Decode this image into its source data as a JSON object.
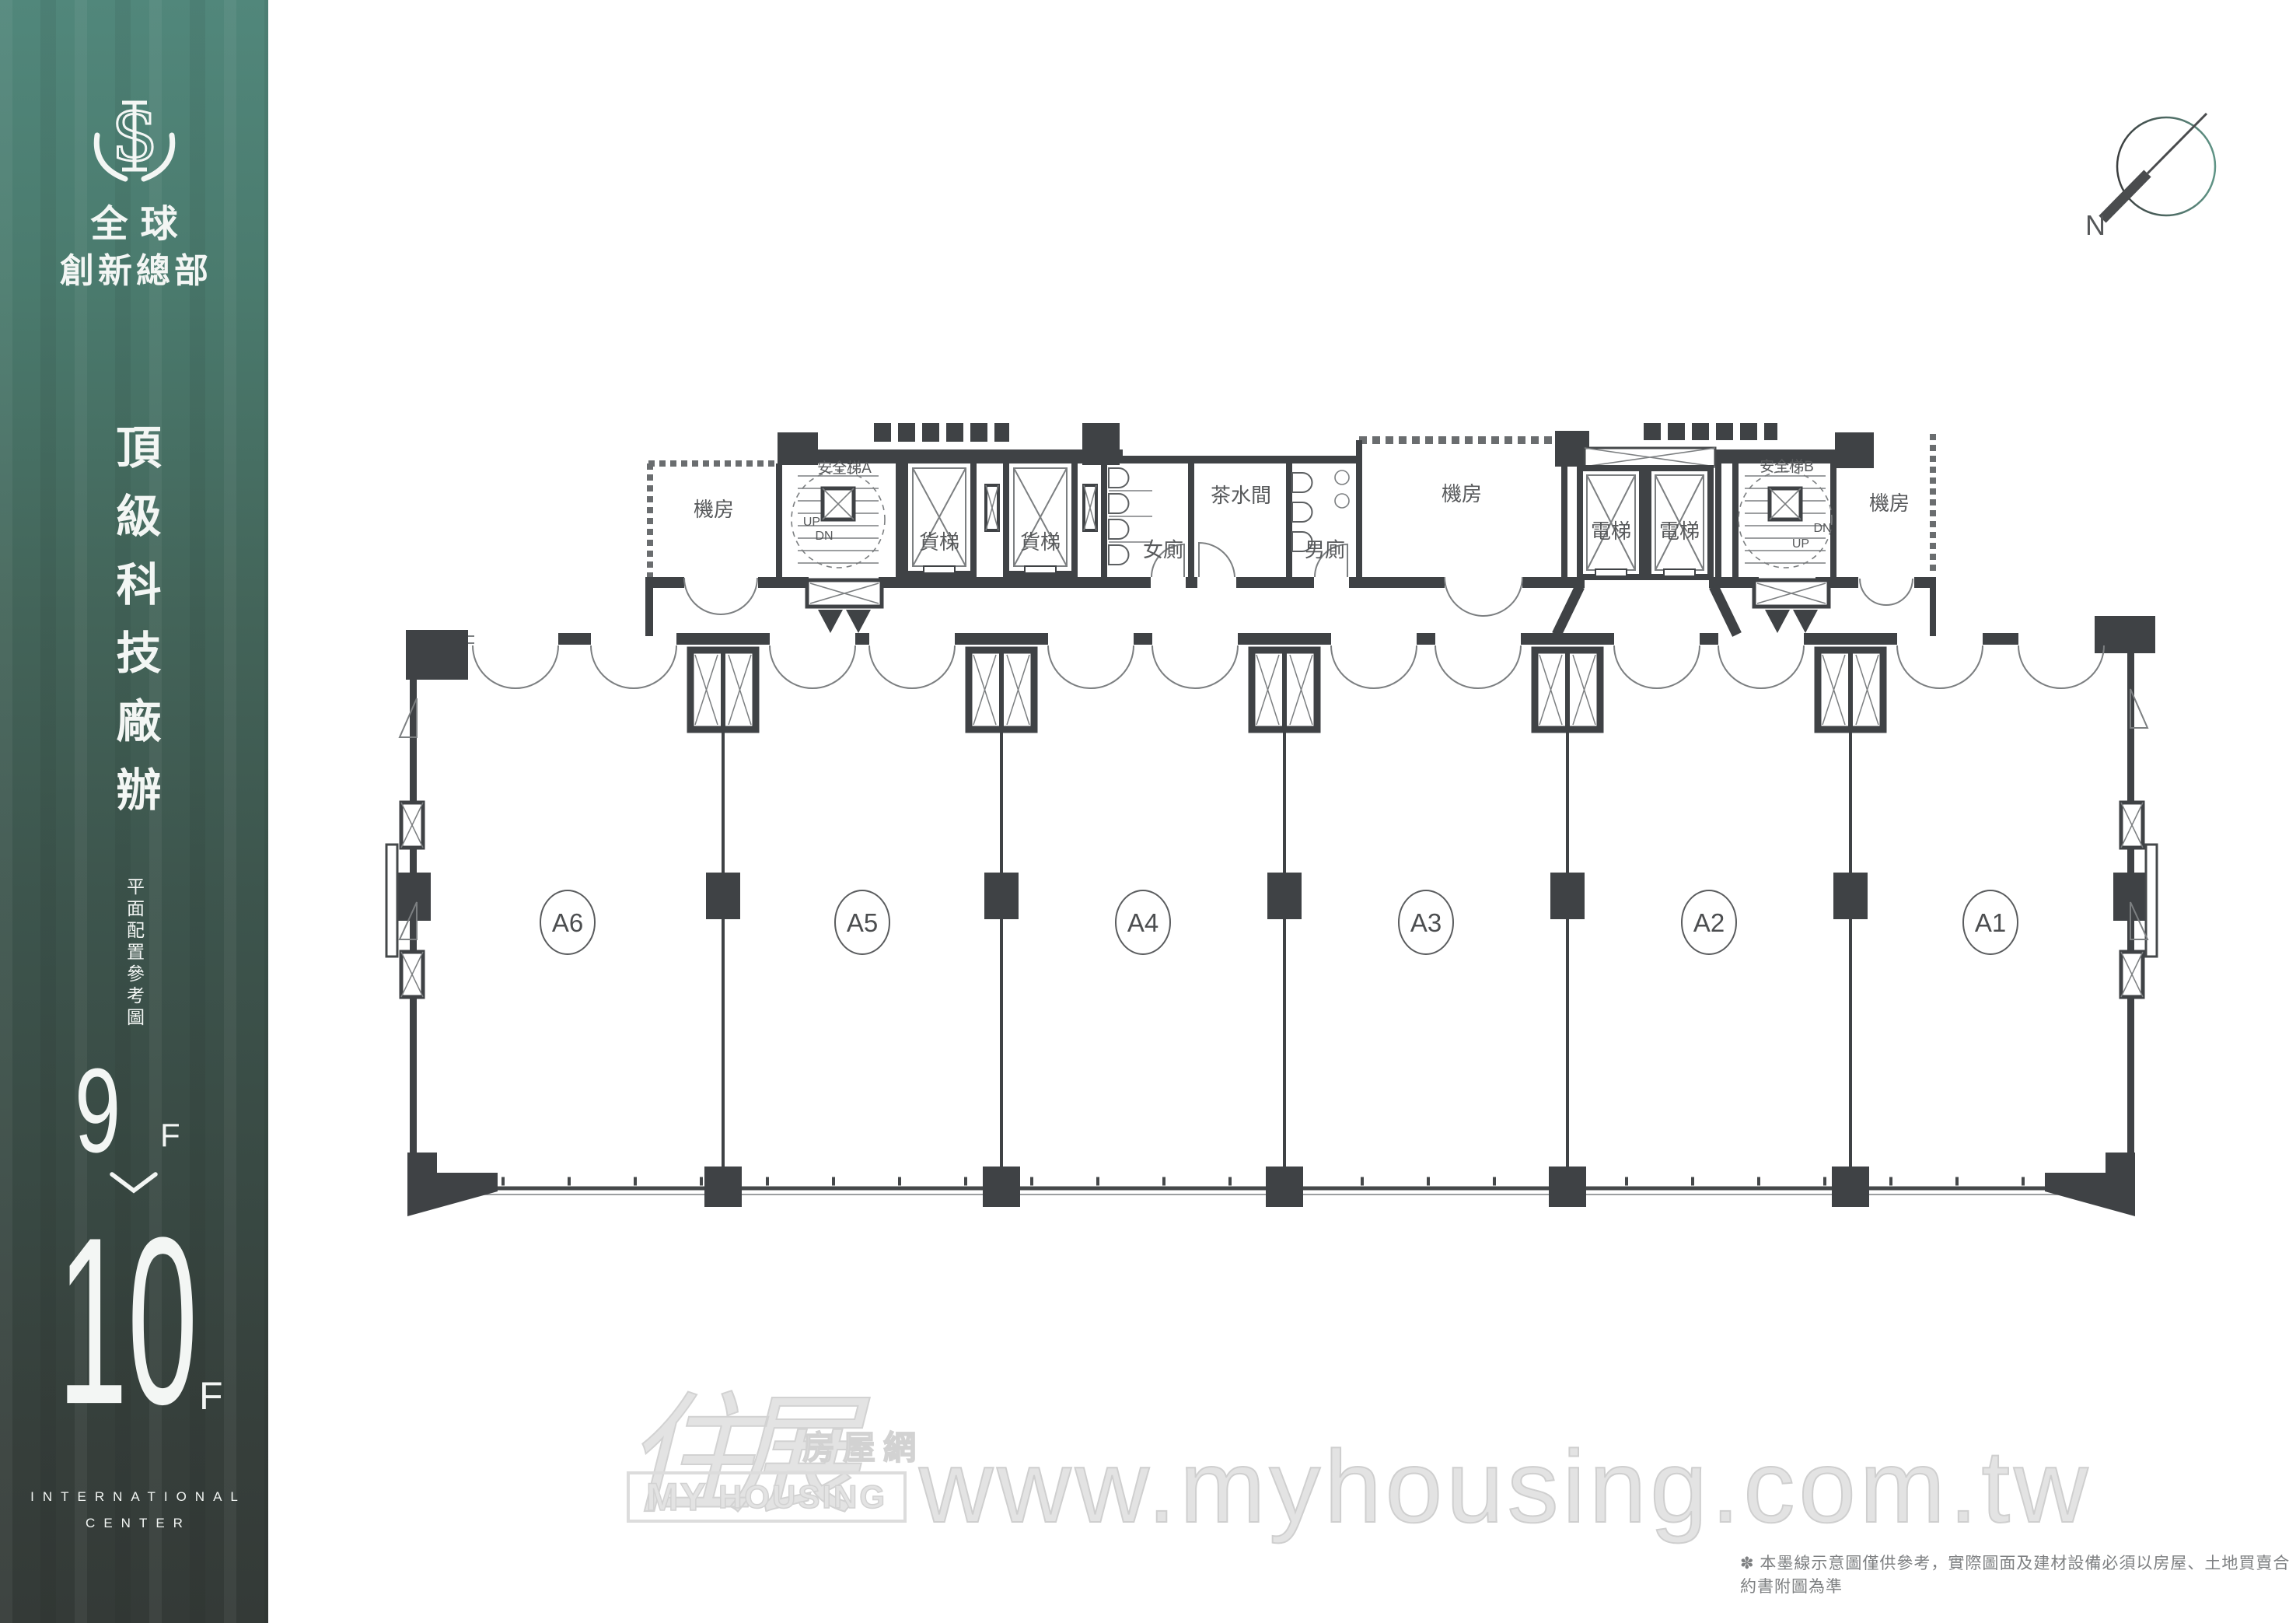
{
  "sidebar": {
    "brand_line1": "全球",
    "brand_line2": "創新總部",
    "title_vertical": "頂級科技廠辦",
    "subtitle_vertical": "平面配置參考圖",
    "floor_from": "9",
    "floor_from_suffix": "F",
    "floor_to": "10",
    "floor_to_suffix": "F",
    "footer_line1": "INTERNATIONAL",
    "footer_line2": "CENTER",
    "color_top": "#51877b",
    "color_bottom": "#343a37"
  },
  "compass": {
    "north_label": "N"
  },
  "plan": {
    "line_color": "#45484a",
    "units": [
      {
        "label": "A6"
      },
      {
        "label": "A5"
      },
      {
        "label": "A4"
      },
      {
        "label": "A3"
      },
      {
        "label": "A2"
      },
      {
        "label": "A1"
      }
    ],
    "rooms": {
      "machine_room": "機房",
      "freight_elevator": "貨梯",
      "elevator": "電梯",
      "safety_stair_a": "安全梯A",
      "safety_stair_b": "安全梯B",
      "womens_toilet": "女廁",
      "mens_toilet": "男廁",
      "pantry": "茶水間",
      "up_label": "UP",
      "down_label": "DN"
    }
  },
  "watermark": {
    "logo_zh_main": "住展",
    "logo_zh_sub": "房屋網",
    "logo_en_word1": "MY",
    "logo_en_word2": "HOUSING",
    "url": "www.myhousing.com.tw",
    "color": "#e3e3e3"
  },
  "disclaimer": "✽ 本墨線示意圖僅供參考，實際圖面及建材設備必須以房屋、土地買賣合約書附圖為準"
}
